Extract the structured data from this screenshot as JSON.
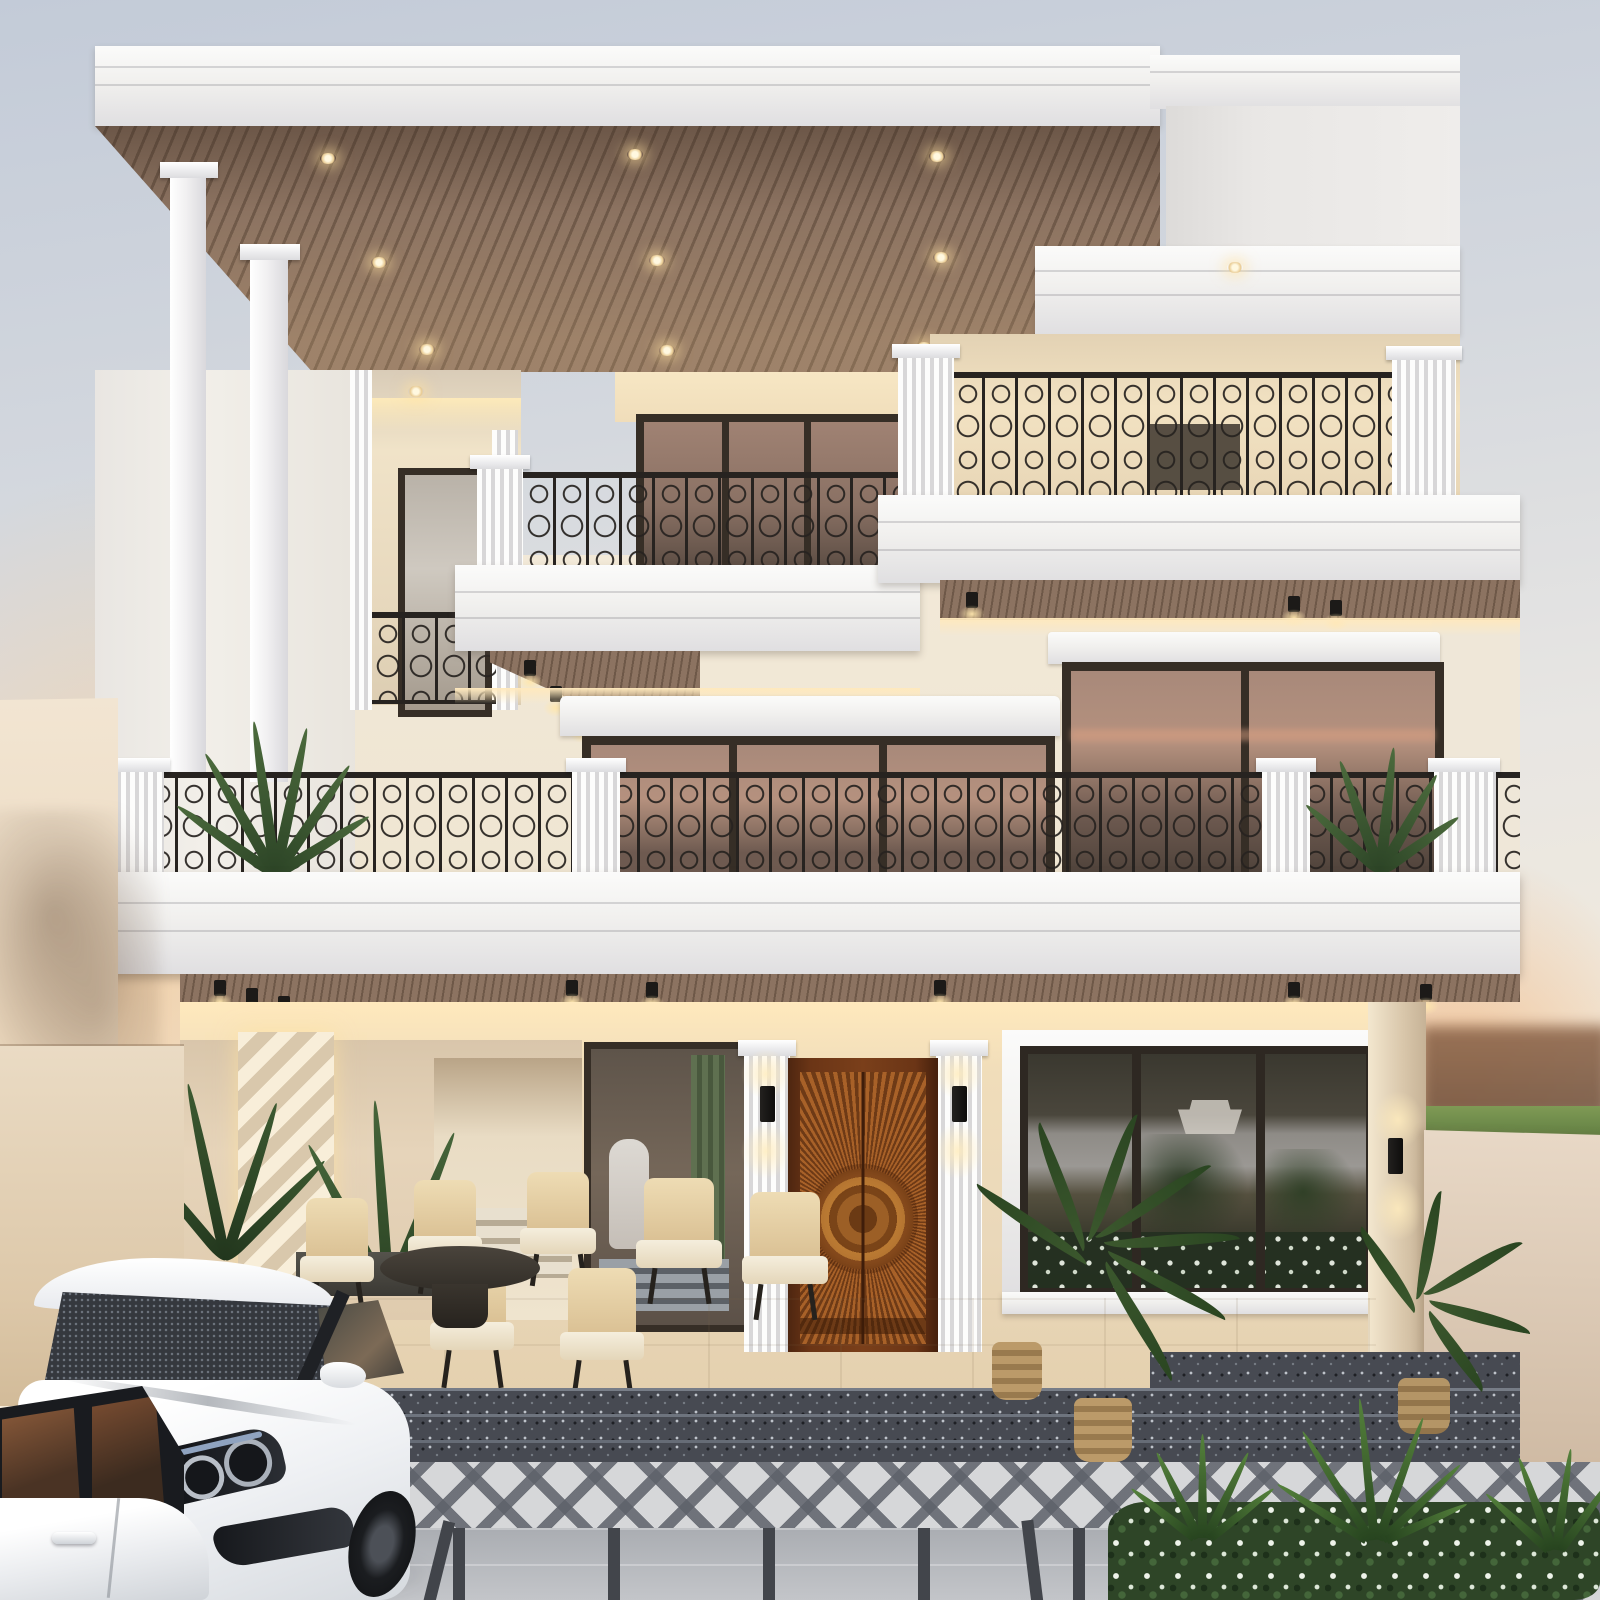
{
  "meta": {
    "title": "Three-storey modern classical villa exterior at dusk",
    "width_px": 1600,
    "height_px": 1600
  },
  "palette": {
    "sky-top": "#c3cbd8",
    "sky-mid": "#e8e6e3",
    "sky-low": "#f6ecd9",
    "glow": "#f6c58a",
    "white-hi": "#fbfbfa",
    "white": "#f1f0ee",
    "white-lo": "#e0dfe1",
    "white-edge": "#c9c9cd",
    "wall-cream": "#efe8dc",
    "wall-warm": "#f3e3c1",
    "cove": "#ffe9bd",
    "wood": "#8c7361",
    "wood-dark": "#6e5848",
    "iron": "#272320",
    "frame": "#362e26",
    "glass-hi": "#a08273",
    "glass-lo": "#584a41",
    "glass-pink": "#b5917e",
    "door-hi": "#c08040",
    "door-mid": "#8a4d1e",
    "door-lo": "#5a2d10",
    "granite": "#474a52",
    "granite-hi": "#878c95",
    "patio": "#e4d9c1",
    "tile": "#b8bbbf",
    "tile-dark": "#42454b",
    "diamond-line": "#5d616a",
    "plant": "#3e5a33",
    "plant-dark": "#263c21",
    "lawn": "#6d8b4a",
    "car": "#f4f5f7",
    "car-shade": "#d7dadf",
    "glass-car": "#33363c",
    "basket": "#b08f5f"
  },
  "scene": {
    "time_of_day": "dusk with warm sunset glow",
    "building": {
      "floors": 3,
      "style": "modern neoclassical villa, white and cream facade",
      "roof": "flat slab with white cornice and wood-slat soffit with recessed lights",
      "slender_porch_columns": 2,
      "balconies_with_wrought_iron_railings": 4,
      "balcony_plants": 2
    },
    "ground_floor": {
      "entrance_door": "carved wood double door with radiating sunburst and circular medallion",
      "flanking_pilasters": "white fluted with black up-down wall sconces",
      "large_picture_window": "dark frame reflecting garden shrubs and white flowers",
      "patio_chairs": 7,
      "patio_table": 1,
      "decor_wall": "faceted diamond relief panel, warm lit",
      "interior_hallway": "visible through glass with steps and scooter"
    },
    "foreground": {
      "cars": 2,
      "car_color": "white",
      "steps_material": "dark speckled granite",
      "driveway": "light grey grid tiles with dark grout and diamond-pattern walkway band",
      "hedge": "dense green with small white flowers",
      "spiky_accent_plants": 3,
      "potted_palms": 3,
      "wicker_baskets": 2
    },
    "right_side": {
      "boundary_wall": "plain beige",
      "lawn_strip": true,
      "horizon": "blurred dark trees under orange sunset sky"
    },
    "left_side": {
      "boundary_wall": "beige with soft tree shadow"
    }
  }
}
